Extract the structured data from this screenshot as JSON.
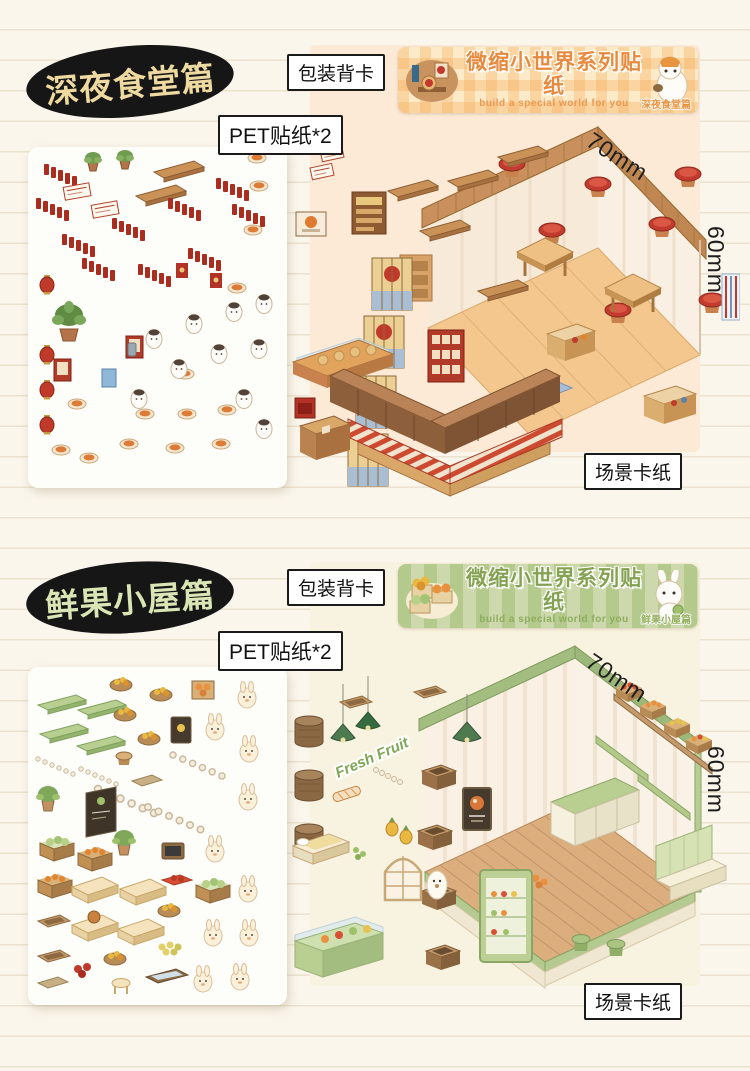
{
  "page": {
    "background_color": "#fbf6ec",
    "rule_line_color": "#ebe2cf"
  },
  "series": {
    "title": "微缩小世界系列贴纸",
    "subtitle": "build a special world for you"
  },
  "sections": [
    {
      "badge": "深夜食堂篇",
      "badge_text_color": "#eed9a0",
      "accent_color": "#e78a3d",
      "packaging_label": "包装背卡",
      "pet_label": "PET贴纸*2",
      "scene_label": "场景卡纸",
      "width_label": "70mm",
      "height_label": "60mm",
      "edition_tag": "深夜食堂篇"
    },
    {
      "badge": "鲜果小屋篇",
      "badge_text_color": "#d9e5b4",
      "accent_color": "#85a253",
      "packaging_label": "包装背卡",
      "pet_label": "PET贴纸*2",
      "scene_label": "场景卡纸",
      "width_label": "70mm",
      "height_label": "60mm",
      "edition_tag": "鲜果小屋篇",
      "scene_sign": "Fresh Fruit"
    }
  ]
}
